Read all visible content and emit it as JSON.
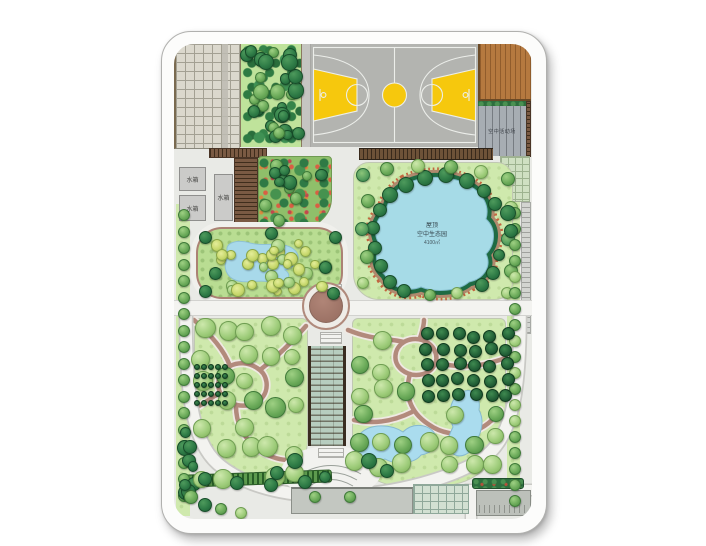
{
  "canvas": {
    "width": 706,
    "height": 546,
    "background": "#ffffff"
  },
  "plan": {
    "type": "landscape-masterplan",
    "labels": {
      "tanks": [
        "水箱",
        "水箱",
        "水箱"
      ],
      "terrace": "空中活动场",
      "lake": {
        "line1": "屋顶",
        "line2": "空中生态园",
        "line3": "4100㎡"
      }
    },
    "colors": {
      "court_gray": "#b3b4b0",
      "court_line": "#eceeea",
      "key_yellow": "#f6c80d",
      "lawn_green": "#cfe9ad",
      "garden_green": "#b9dd92",
      "water_blue": "#a6dbe7",
      "lake_fringe_green": "#1f6b43",
      "path_mauve": "#b28a7c",
      "path_white": "#f3f3f0",
      "wood_deck": "#b5793f",
      "plaza_brown": "#9c7265",
      "hedge_dark": "#2e7b46"
    }
  }
}
